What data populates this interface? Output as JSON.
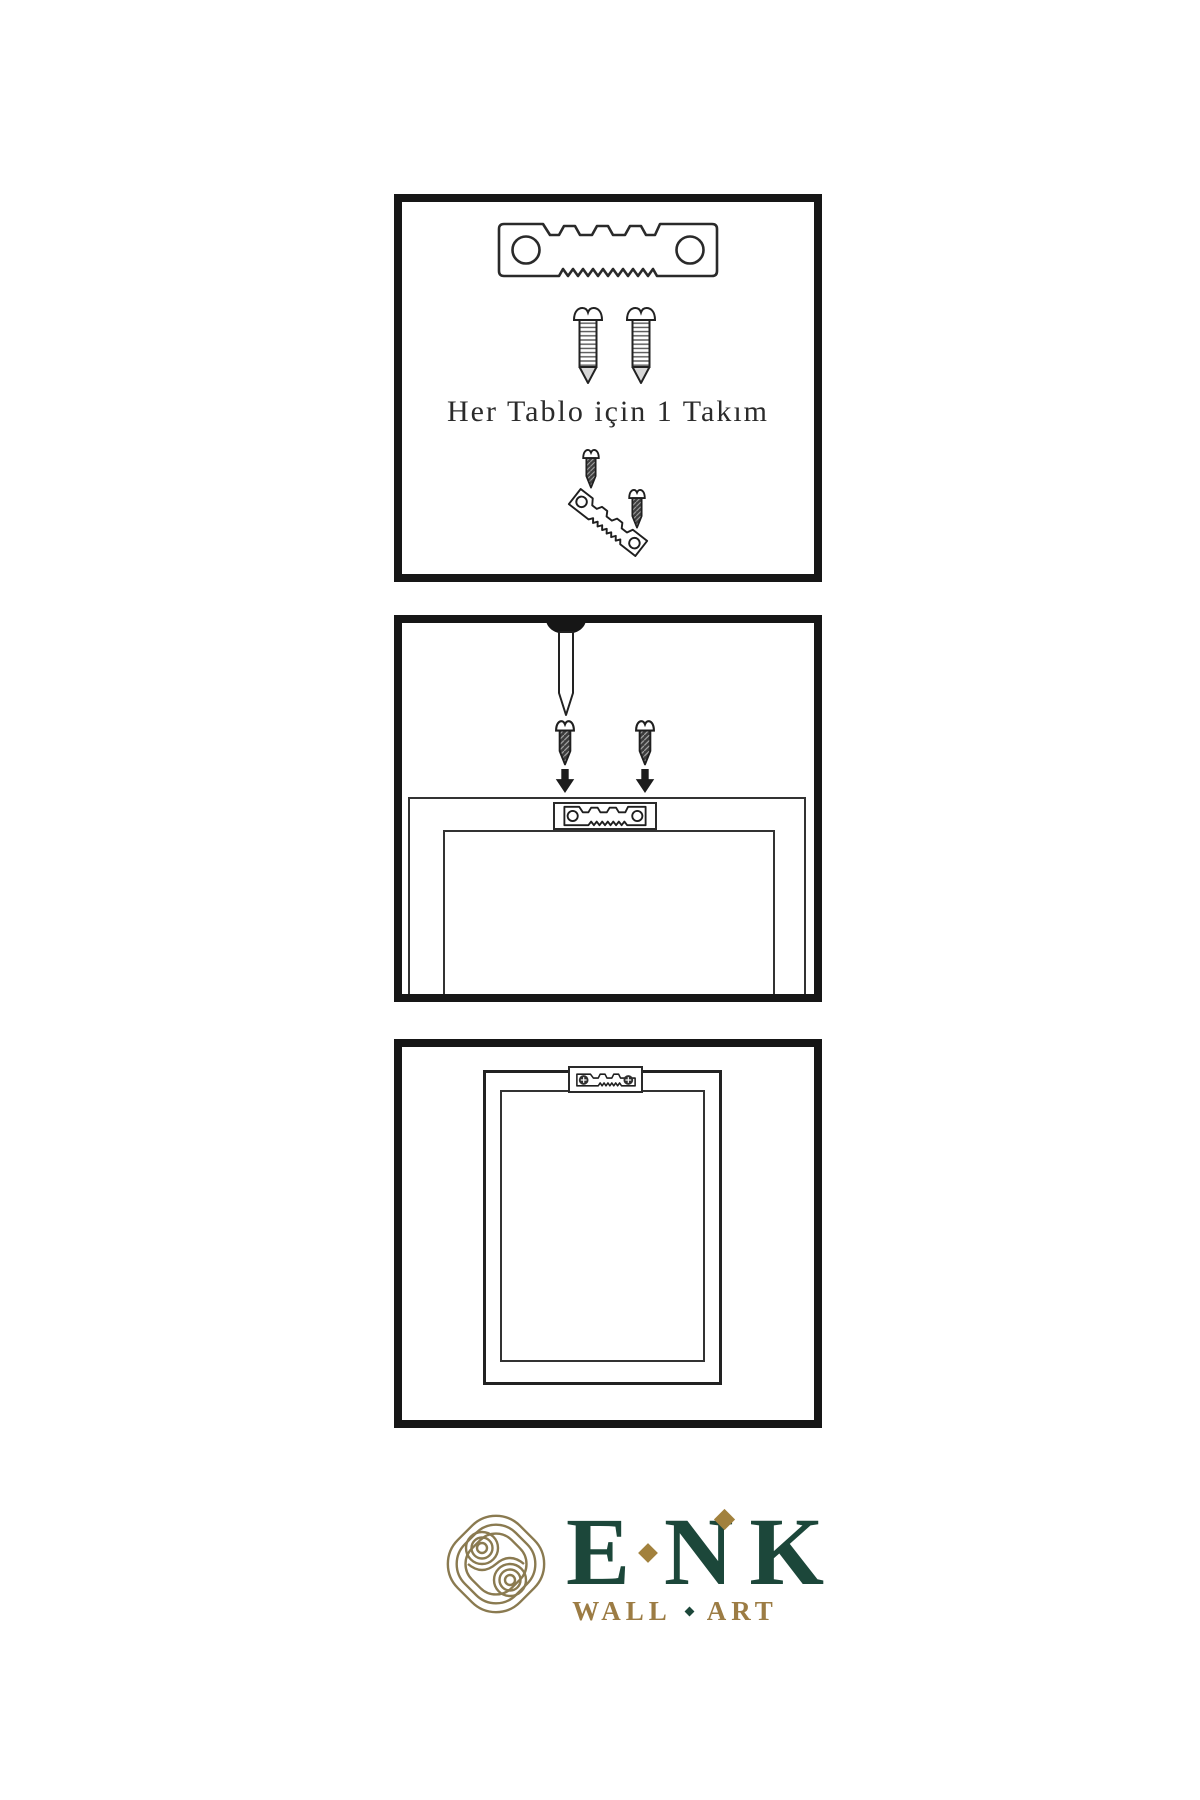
{
  "page": {
    "bg": "#ffffff",
    "ink": "#2b2b2b",
    "panel_border": "#161616"
  },
  "panel1": {
    "name": "kit-contents",
    "caption": "Her Tablo için 1 Takım",
    "items": [
      "sawtooth-hanger-icon",
      "mounting-screw-icon",
      "mounting-screw-icon",
      "screws-into-tilted-hanger-icon"
    ]
  },
  "panel2": {
    "name": "installation-step",
    "items": [
      "wall-nail-icon",
      "dark-screw-icon",
      "down-arrow-icon",
      "dark-screw-icon",
      "down-arrow-icon",
      "frame-back-with-hanger-plate-icon"
    ]
  },
  "panel3": {
    "name": "mounted-result",
    "items": [
      "frame-back-with-mounted-hanger-icon"
    ]
  },
  "brand": {
    "icon": "knot-icon",
    "name": "ENK",
    "name_letters": [
      "E",
      "N",
      "K"
    ],
    "subtitle": "WALL ART",
    "subtitle_words": [
      "WALL",
      "ART"
    ],
    "colors": {
      "green": "#1c473a",
      "gold": "#9c7c44",
      "knot": "#8a7a50",
      "diamond": "#a2813d"
    }
  }
}
